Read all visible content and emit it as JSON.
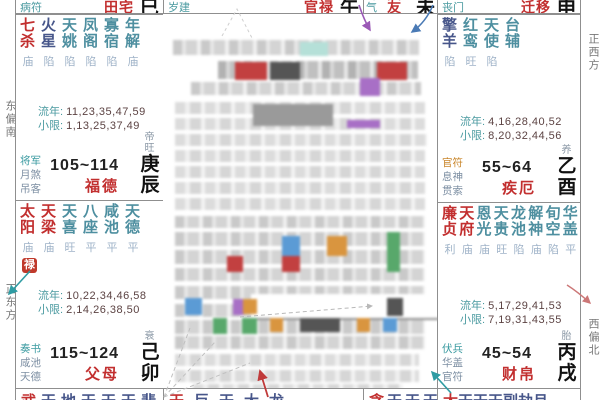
{
  "directions": {
    "left_top": "东偏南",
    "left_bottom": "正东方",
    "right_top": "正西方",
    "right_bottom": "西偏北"
  },
  "labels": {
    "liunian": "流年:",
    "xiaoxian": "小限:"
  },
  "colors": {
    "main_star": "#c22f2f",
    "malefic_star": "#47568a",
    "minor_star": "#4e8fa0",
    "palace_name": "#c22f2f",
    "status": "#9fb3c8",
    "god_primary": "#3a9aa0",
    "god_secondary": "#7d8fa3",
    "god_annual_orange": "#c9862b",
    "lu_badge": "#c0392b",
    "border": "#8f8f8f"
  },
  "top_cells": [
    {
      "god": "病符",
      "palace": "田宅",
      "branch": "巳"
    },
    {
      "god": "岁建",
      "palace": "官禄",
      "branch": "午"
    },
    {
      "god": "晦气",
      "palace": "交友",
      "branch": "未"
    },
    {
      "god": "丧门",
      "palace": "迁移",
      "branch": "申"
    }
  ],
  "palaces": {
    "fude": {
      "stars": [
        {
          "n": "七杀",
          "s": "庙",
          "c": "#c22f2f"
        },
        {
          "n": "火星",
          "s": "陷",
          "c": "#47568a"
        },
        {
          "n": "天姚",
          "s": "陷",
          "c": "#4e8fa0"
        },
        {
          "n": "凤阁",
          "s": "陷",
          "c": "#4e8fa0"
        },
        {
          "n": "寡宿",
          "s": "陷",
          "c": "#4e8fa0"
        },
        {
          "n": "年解",
          "s": "庙",
          "c": "#4e8fa0"
        }
      ],
      "liunian": "11,23,35,47,59",
      "xiaoxian": "1,13,25,37,49",
      "gods": [
        {
          "t": "将军",
          "c": "#3a9aa0"
        },
        {
          "t": "月煞",
          "c": "#7d8fa3"
        },
        {
          "t": "吊客",
          "c": "#7d8fa3"
        }
      ],
      "age": "105~114",
      "name": "福德",
      "sheng": "帝旺",
      "branch": "庚辰"
    },
    "fumu": {
      "stars": [
        {
          "n": "太阳",
          "s": "庙",
          "c": "#c22f2f"
        },
        {
          "n": "天梁",
          "s": "庙",
          "c": "#c22f2f"
        },
        {
          "n": "天喜",
          "s": "旺",
          "c": "#4e8fa0"
        },
        {
          "n": "八座",
          "s": "平",
          "c": "#4e8fa0"
        },
        {
          "n": "咸池",
          "s": "平",
          "c": "#4e8fa0"
        },
        {
          "n": "天德",
          "s": "平",
          "c": "#4e8fa0"
        }
      ],
      "badge": "禄",
      "liunian": "10,22,34,46,58",
      "xiaoxian": "2,14,26,38,50",
      "gods": [
        {
          "t": "奏书",
          "c": "#3a9aa0"
        },
        {
          "t": "咸池",
          "c": "#7d8fa3"
        },
        {
          "t": "天德",
          "c": "#7d8fa3"
        }
      ],
      "age": "115~124",
      "name": "父母",
      "sheng": "衰",
      "branch": "己卯"
    },
    "jie": {
      "stars": [
        {
          "n": "擎羊",
          "s": "陷",
          "c": "#47568a"
        },
        {
          "n": "红鸾",
          "s": "旺",
          "c": "#4e8fa0"
        },
        {
          "n": "天使",
          "s": "陷",
          "c": "#4e8fa0"
        },
        {
          "n": "台辅",
          "s": "",
          "c": "#4e8fa0"
        }
      ],
      "liunian": "4,16,28,40,52",
      "xiaoxian": "8,20,32,44,56",
      "gods": [
        {
          "t": "官符",
          "c": "#c9862b"
        },
        {
          "t": "息神",
          "c": "#7d8fa3"
        },
        {
          "t": "贯索",
          "c": "#7d8fa3"
        }
      ],
      "age": "55~64",
      "name": "疾厄",
      "sheng": "养",
      "branch": "乙酉"
    },
    "caibo": {
      "stars": [
        {
          "n": "廉贞",
          "s": "利",
          "c": "#c22f2f"
        },
        {
          "n": "天府",
          "s": "庙",
          "c": "#c22f2f"
        },
        {
          "n": "恩光",
          "s": "庙",
          "c": "#4e8fa0"
        },
        {
          "n": "天贵",
          "s": "旺",
          "c": "#4e8fa0"
        },
        {
          "n": "龙池",
          "s": "陷",
          "c": "#4e8fa0"
        },
        {
          "n": "解神",
          "s": "庙",
          "c": "#4e8fa0"
        },
        {
          "n": "旬空",
          "s": "陷",
          "c": "#4e8fa0"
        },
        {
          "n": "华盖",
          "s": "平",
          "c": "#4e8fa0"
        }
      ],
      "liunian": "5,17,29,41,53",
      "xiaoxian": "7,19,31,43,55",
      "gods": [
        {
          "t": "伏兵",
          "c": "#3a9aa0"
        },
        {
          "t": "华盖",
          "c": "#7d8fa3"
        },
        {
          "t": "官符",
          "c": "#7d8fa3"
        }
      ],
      "age": "45~54",
      "name": "财帛",
      "sheng": "胎",
      "branch": "丙戌"
    }
  },
  "bottom_cells": [
    {
      "first": "武",
      "rest": "天地天天天蜚"
    },
    {
      "first": "天",
      "rest": "巨天大龙"
    },
    {
      "first": "贪",
      "rest": "天天天"
    },
    {
      "first": "太",
      "rest": "天天天副劫月"
    }
  ]
}
